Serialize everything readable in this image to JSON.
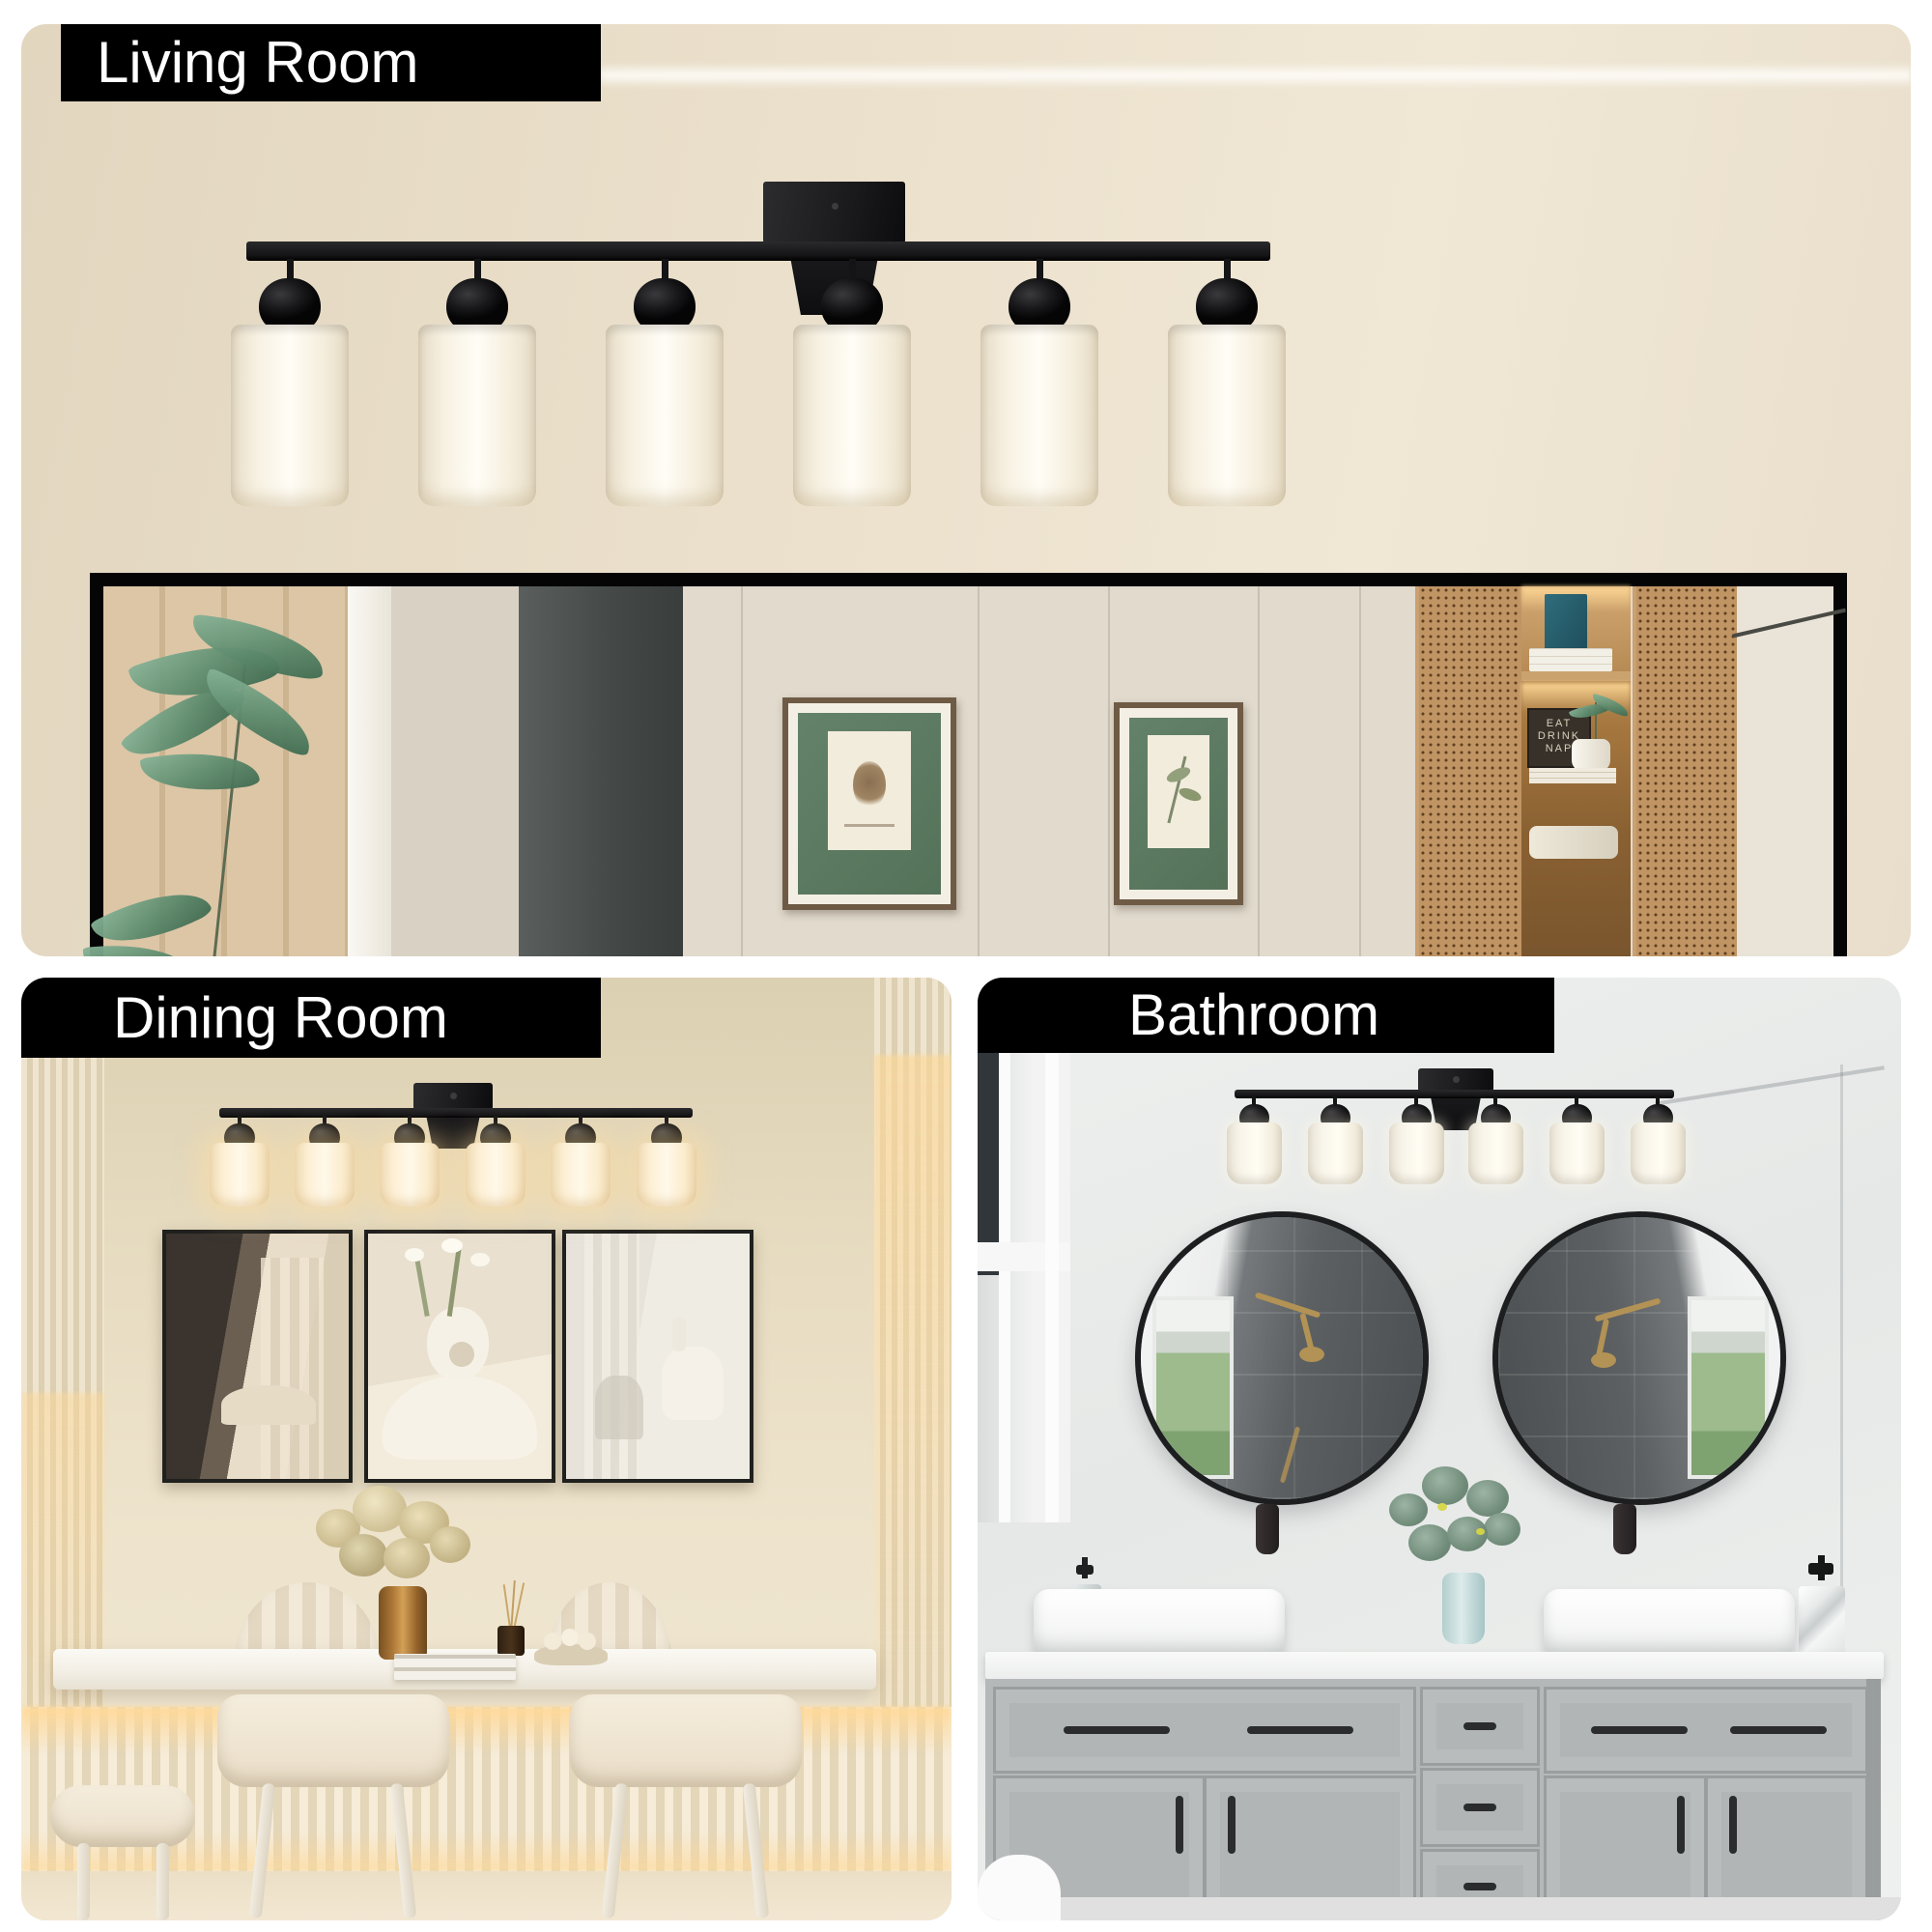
{
  "product": {
    "light_count": 6,
    "metal_color": "#1b1b1d",
    "shade_color": "#f7f1e4"
  },
  "sections": {
    "living": {
      "label": "Living Room"
    },
    "dining": {
      "label": "Dining Room"
    },
    "bathroom": {
      "label": "Bathroom"
    }
  },
  "living_inset": {
    "cabinet_sign_lines": [
      "EAT",
      "DRINK",
      "NAP"
    ]
  },
  "colors": {
    "label_background": "#000000",
    "label_text": "#ffffff",
    "living_wall": "#ece2cf",
    "dining_wall": "#e7dcc1",
    "bathroom_wall": "#eceeed",
    "vanity_cabinet": "#b5b8b9",
    "print_mat_green": "#5c7a61"
  }
}
